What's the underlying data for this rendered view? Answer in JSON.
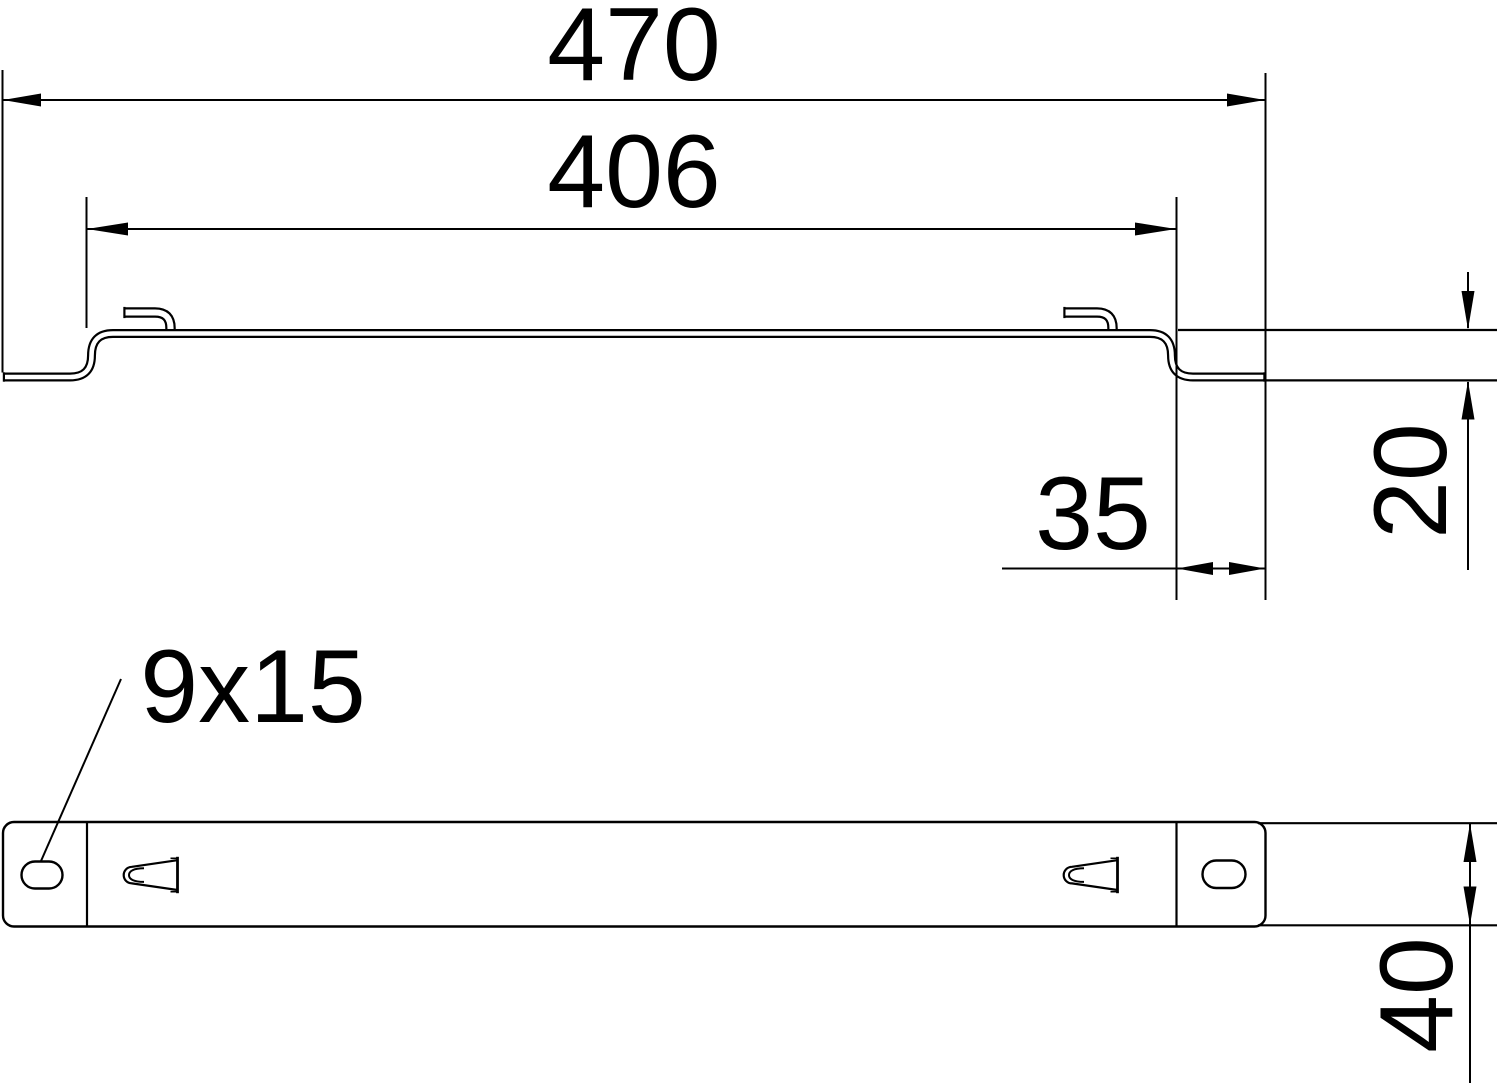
{
  "drawing": {
    "background_color": "#ffffff",
    "line_color": "#000000",
    "labels": {
      "overall_width": "470",
      "top_flat_width": "406",
      "end_offset": "35",
      "step_height": "20",
      "slot_size": "9x15",
      "rail_width": "40"
    }
  }
}
